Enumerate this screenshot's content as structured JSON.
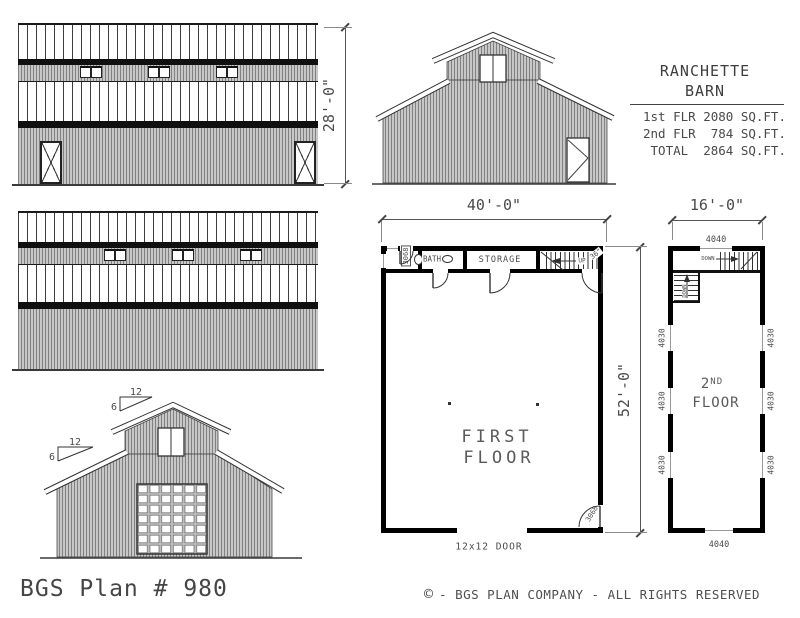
{
  "colors": {
    "siding_gray": "#c7c7c7",
    "roof_seam": "#3d3d3d",
    "wall_black": "#000000",
    "eave_shadow": "#101010",
    "text_gray": "#4a4a4a",
    "dim_gray": "#555555"
  },
  "title_block": {
    "name_line1": "RANCHETTE",
    "name_line2": "BARN",
    "area_rows": [
      "1st FLR 2080 SQ.FT.",
      "2nd FLR  784 SQ.FT.",
      " TOTAL  2864 SQ.FT."
    ]
  },
  "dimensions": {
    "elevation_height": "28'-0\"",
    "first_floor_width": "40'-0\"",
    "first_floor_depth": "52'-0\"",
    "second_floor_width": "16'-0\""
  },
  "roof_pitch": {
    "run": "12",
    "rise": "6"
  },
  "first_floor": {
    "title_line1": "FIRST",
    "title_line2": "FLOOR",
    "bath_label": "BATH",
    "storage_label": "STORAGE",
    "up_label": "UP",
    "stair_width_label": "36\"",
    "entry_door_label": "3068",
    "side_door_label": "3068",
    "overhead_door_label": "12x12 DOOR"
  },
  "second_floor": {
    "title_number": "2",
    "title_suffix": "ND",
    "title_word": "FLOOR",
    "down_label": "DOWN",
    "window_front": "4040",
    "window_rear": "4040",
    "window_side": "4030"
  },
  "footer": {
    "plan_title": "BGS Plan # 980",
    "copyright_symbol": "©",
    "copyright_text": "- BGS PLAN COMPANY - ALL RIGHTS RESERVED"
  }
}
